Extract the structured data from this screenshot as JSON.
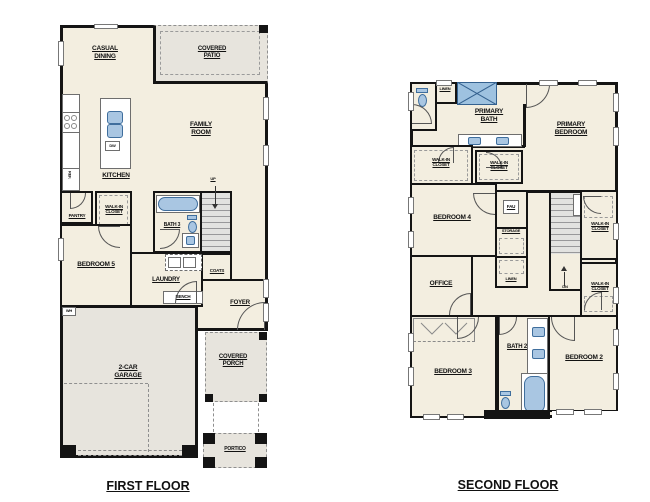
{
  "colors": {
    "floor": "#f3eee0",
    "outdoor": "#e7e4dd",
    "wall": "#141414",
    "fixture_fill": "#a9c6e2",
    "fixture_border": "#3f6e9d"
  },
  "first_floor": {
    "title": "FIRST FLOOR",
    "rooms": {
      "casual_dining": "CASUAL DINING",
      "covered_patio": "COVERED PATIO",
      "family_room": "FAMILY ROOM",
      "kitchen": "KITCHEN",
      "pantry": "PANTRY",
      "walk_in_closet": "WALK-IN CLOSET",
      "bath_3": "BATH 3",
      "bedroom_5": "BEDROOM 5",
      "laundry": "LAUNDRY",
      "coats": "COATS",
      "foyer": "FOYER",
      "garage": "2-CAR GARAGE",
      "covered_porch": "COVERED PORCH",
      "portico": "PORTICO"
    },
    "annotations": {
      "ref": "REF.",
      "dw": "DW",
      "bench": "BENCH",
      "wh": "WH",
      "up": "UP"
    }
  },
  "second_floor": {
    "title": "SECOND FLOOR",
    "rooms": {
      "primary_bath": "PRIMARY BATH",
      "primary_bedroom": "PRIMARY BEDROOM",
      "linen_upper": "LINEN",
      "walk_in_closet_left": "WALK-IN CLOSET",
      "walk_in_closet_center": "WALK-IN CLOSET",
      "bedroom_4": "BEDROOM 4",
      "office": "OFFICE",
      "walk_in_closet_right_upper": "WALK-IN CLOSET",
      "walk_in_closet_right_lower": "WALK-IN CLOSET",
      "bedroom_3": "BEDROOM 3",
      "bath_2": "BATH 2",
      "bedroom_2": "BEDROOM 2"
    },
    "annotations": {
      "fau": "FAU",
      "storage": "STORAGE",
      "linen": "LINEN",
      "dn": "DN"
    }
  }
}
